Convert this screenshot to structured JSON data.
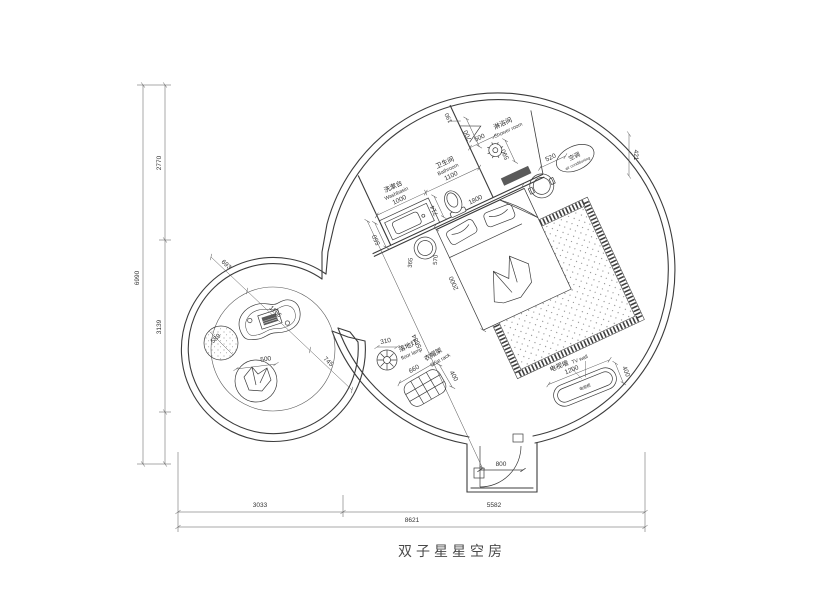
{
  "drawing": {
    "title": "双子星星空房",
    "washbasin": {
      "cn": "洗漱台",
      "en": "Washbasin",
      "width": "1000",
      "depth": "550"
    },
    "bathroom": {
      "cn": "卫生间",
      "en": "Bathroom",
      "width": "1100",
      "d190": "190",
      "d700": "700",
      "d714": "714"
    },
    "shower": {
      "cn": "淋浴间",
      "en": "Shower room",
      "d500": "500",
      "d590": "590"
    },
    "ac": {
      "cn": "空调",
      "en": "air conditioning",
      "d520": "520",
      "d421": "421"
    },
    "bed": {
      "width": "1800",
      "length": "2000",
      "diag": "5684",
      "stool_a": "365",
      "stool_b": "570"
    },
    "tv": {
      "wall_cn": "电视墙",
      "wall_en": "TV wall",
      "cab_cn": "电视柜",
      "d1200": "1200",
      "d400": "400"
    },
    "coatrack": {
      "cn": "衣帽架",
      "en": "Coat rack",
      "d660": "660",
      "d400": "400"
    },
    "floorlamp": {
      "cn": "落地灯",
      "en": "floor lamp",
      "d310": "310"
    },
    "lounge": {
      "d693": "693",
      "d1166": "1166",
      "d745": "745",
      "d589": "589",
      "d500": "500"
    },
    "door": {
      "d800": "800"
    },
    "overall": {
      "left_total": "6990",
      "left_top": "2770",
      "left_bottom": "3139",
      "bottom_left": "3033",
      "bottom_right": "5582",
      "bottom_total": "8621"
    }
  }
}
